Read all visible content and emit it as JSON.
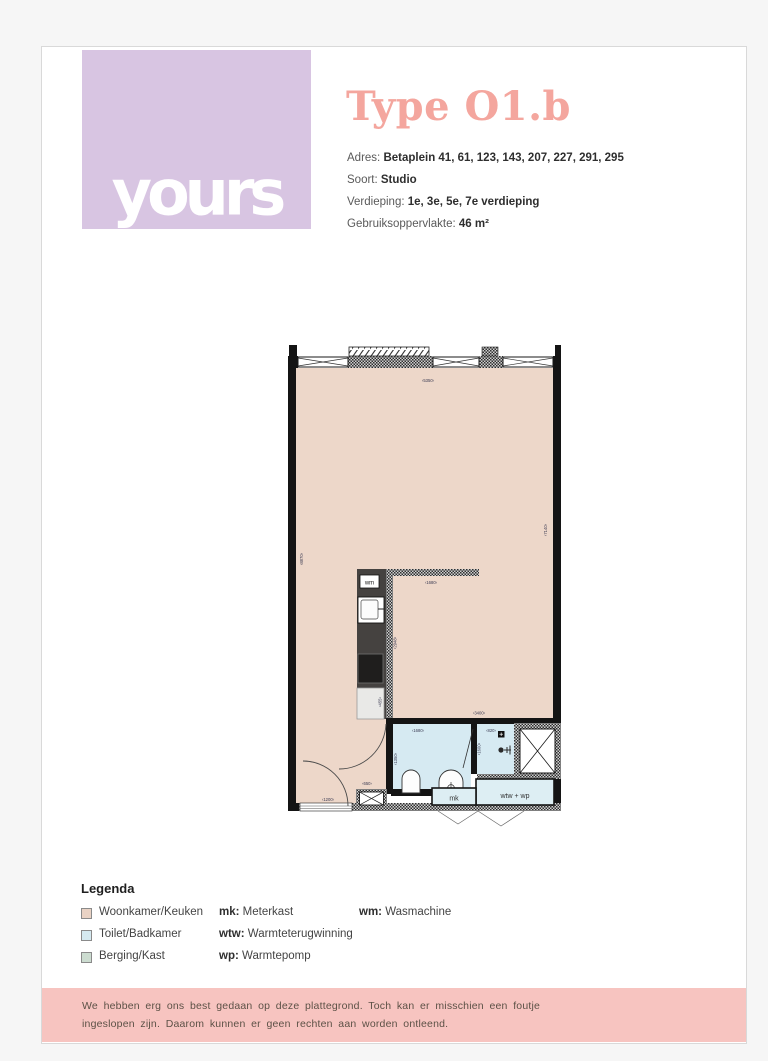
{
  "header": {
    "logo_text": "yours",
    "title": "Type O1.b",
    "meta": [
      {
        "label": "Adres:",
        "value": "Betaplein 41, 61, 123, 143, 207, 227, 291, 295"
      },
      {
        "label": "Soort:",
        "value": "Studio"
      },
      {
        "label": "Verdieping:",
        "value": "1e, 3e, 5e, 7e verdieping"
      },
      {
        "label": "Gebruiksoppervlakte:",
        "value": "46 m²"
      }
    ]
  },
  "plan": {
    "dims": {
      "top_width": "‹5350›",
      "left_height": "‹8870›",
      "right_height": "‹7140›",
      "kitchen_wall": "‹1680›",
      "kitchen_wall_v": "‹2948›",
      "counter": "‹455›",
      "bath_top": "‹3400›",
      "bath_width": "‹1680›",
      "bath_depth": "‹1350›",
      "shower_width": "‹820›",
      "shower_depth": "‹1600›",
      "hall_door": "‹650›",
      "entrance_door": "‹1200›"
    },
    "labels": {
      "washer": "wm",
      "meterkast": "mk",
      "heatpump": "wtw + wp"
    }
  },
  "legend": {
    "heading": "Legenda",
    "rooms": [
      {
        "label": "Woonkamer/Keuken",
        "color": "#e9d2c4"
      },
      {
        "label": "Toilet/Badkamer",
        "color": "#d5e9f0"
      },
      {
        "label": "Berging/Kast",
        "color": "#ccdcd0"
      }
    ],
    "abbrs": [
      {
        "abbr": "mk:",
        "label": "Meterkast"
      },
      {
        "abbr": "wtw:",
        "label": "Warmteterugwinning"
      },
      {
        "abbr": "wp:",
        "label": "Warmtepomp"
      }
    ],
    "abbrs2": [
      {
        "abbr": "wm:",
        "label": "Wasmachine"
      }
    ]
  },
  "footer": {
    "line1": "We hebben erg ons best gedaan op deze plattegrond. Toch kan er misschien een foutje",
    "line2": "ingeslopen zijn. Daarom kunnen er geen rechten aan worden ontleend."
  },
  "colors": {
    "logo_purple": "#d8c5e2",
    "title_salmon": "#f4a69e",
    "floor_tan": "#edd7c9",
    "bath_blue": "#d6eaf2",
    "berging_green": "#ccdcd0",
    "kitchen_dark": "#454240",
    "footer_pink": "#f7c4c0"
  }
}
